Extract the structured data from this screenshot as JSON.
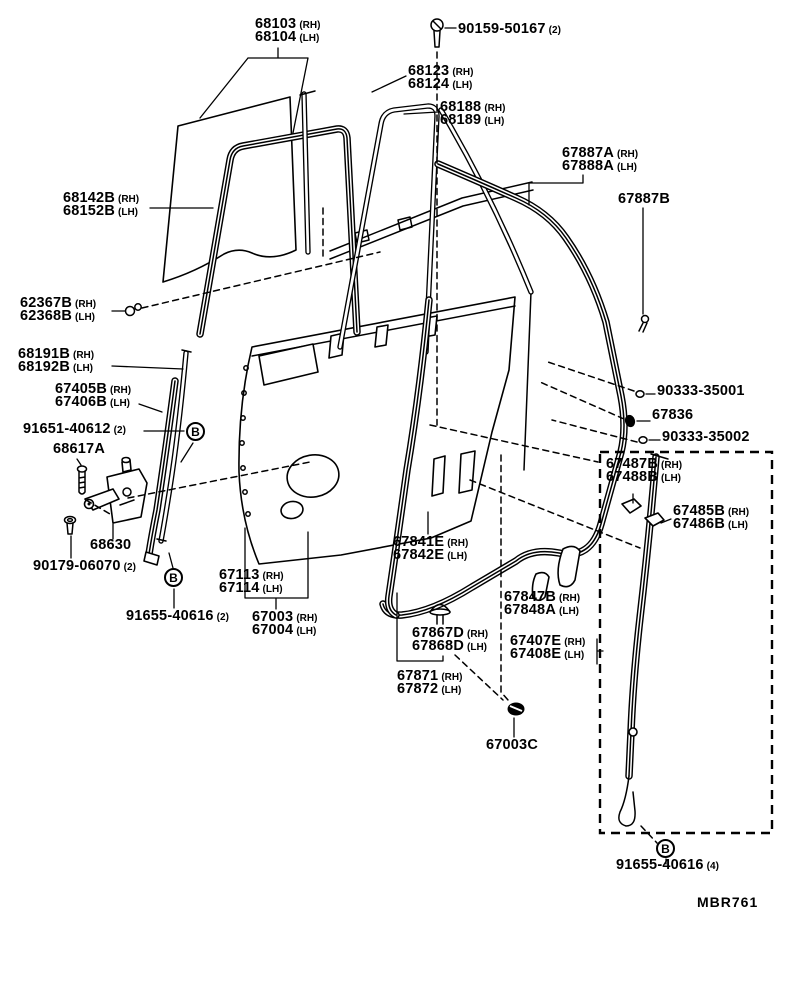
{
  "figure": {
    "code": "MBR761"
  },
  "labels": [
    {
      "id": "68103-68104",
      "x": 255,
      "y": 17,
      "rows": [
        {
          "num": "68103",
          "suffix": "(RH)"
        },
        {
          "num": "68104",
          "suffix": "(LH)"
        }
      ]
    },
    {
      "id": "90159-50167",
      "x": 458,
      "y": 22,
      "rows": [
        {
          "num": "90159-50167",
          "suffix": "(2)"
        }
      ]
    },
    {
      "id": "68123-68124",
      "x": 408,
      "y": 64,
      "rows": [
        {
          "num": "68123",
          "suffix": "(RH)"
        },
        {
          "num": "68124",
          "suffix": "(LH)"
        }
      ]
    },
    {
      "id": "68188-68189",
      "x": 440,
      "y": 100,
      "rows": [
        {
          "num": "68188",
          "suffix": "(RH)"
        },
        {
          "num": "68189",
          "suffix": "(LH)"
        }
      ]
    },
    {
      "id": "67887A-67888A",
      "x": 562,
      "y": 146,
      "rows": [
        {
          "num": "67887A",
          "suffix": "(RH)"
        },
        {
          "num": "67888A",
          "suffix": "(LH)"
        }
      ]
    },
    {
      "id": "67887B",
      "x": 618,
      "y": 192,
      "rows": [
        {
          "num": "67887B",
          "suffix": ""
        }
      ]
    },
    {
      "id": "68142B-68152B",
      "x": 63,
      "y": 191,
      "rows": [
        {
          "num": "68142B",
          "suffix": "(RH)"
        },
        {
          "num": "68152B",
          "suffix": "(LH)"
        }
      ]
    },
    {
      "id": "62367B-62368B",
      "x": 20,
      "y": 296,
      "rows": [
        {
          "num": "62367B",
          "suffix": "(RH)"
        },
        {
          "num": "62368B",
          "suffix": "(LH)"
        }
      ]
    },
    {
      "id": "68191B-68192B",
      "x": 18,
      "y": 347,
      "rows": [
        {
          "num": "68191B",
          "suffix": "(RH)"
        },
        {
          "num": "68192B",
          "suffix": "(LH)"
        }
      ]
    },
    {
      "id": "67405B-67406B",
      "x": 55,
      "y": 382,
      "rows": [
        {
          "num": "67405B",
          "suffix": "(RH)"
        },
        {
          "num": "67406B",
          "suffix": "(LH)"
        }
      ]
    },
    {
      "id": "91651-40612",
      "x": 23,
      "y": 422,
      "rows": [
        {
          "num": "91651-40612",
          "suffix": "(2)"
        }
      ]
    },
    {
      "id": "68617A",
      "x": 53,
      "y": 442,
      "rows": [
        {
          "num": "68617A",
          "suffix": ""
        }
      ]
    },
    {
      "id": "68630",
      "x": 90,
      "y": 538,
      "rows": [
        {
          "num": "68630",
          "suffix": ""
        }
      ]
    },
    {
      "id": "90179-06070",
      "x": 33,
      "y": 559,
      "rows": [
        {
          "num": "90179-06070",
          "suffix": "(2)"
        }
      ]
    },
    {
      "id": "91655-40616-2",
      "x": 126,
      "y": 609,
      "rows": [
        {
          "num": "91655-40616",
          "suffix": "(2)"
        }
      ]
    },
    {
      "id": "67113-67114",
      "x": 219,
      "y": 568,
      "rows": [
        {
          "num": "67113",
          "suffix": "(RH)"
        },
        {
          "num": "67114",
          "suffix": "(LH)"
        }
      ]
    },
    {
      "id": "67003-67004",
      "x": 252,
      "y": 610,
      "rows": [
        {
          "num": "67003",
          "suffix": "(RH)"
        },
        {
          "num": "67004",
          "suffix": "(LH)"
        }
      ]
    },
    {
      "id": "67841E-67842E",
      "x": 393,
      "y": 535,
      "rows": [
        {
          "num": "67841E",
          "suffix": "(RH)"
        },
        {
          "num": "67842E",
          "suffix": "(LH)"
        }
      ]
    },
    {
      "id": "67867D-67868D",
      "x": 412,
      "y": 626,
      "rows": [
        {
          "num": "67867D",
          "suffix": "(RH)"
        },
        {
          "num": "67868D",
          "suffix": "(LH)"
        }
      ]
    },
    {
      "id": "67871-67872",
      "x": 397,
      "y": 669,
      "rows": [
        {
          "num": "67871",
          "suffix": "(RH)"
        },
        {
          "num": "67872",
          "suffix": "(LH)"
        }
      ]
    },
    {
      "id": "67003C",
      "x": 486,
      "y": 738,
      "rows": [
        {
          "num": "67003C",
          "suffix": ""
        }
      ]
    },
    {
      "id": "67847B-67848A",
      "x": 504,
      "y": 590,
      "rows": [
        {
          "num": "67847B",
          "suffix": "(RH)"
        },
        {
          "num": "67848A",
          "suffix": "(LH)"
        }
      ]
    },
    {
      "id": "67407E-67408E",
      "x": 510,
      "y": 634,
      "rows": [
        {
          "num": "67407E",
          "suffix": "(RH)"
        },
        {
          "num": "67408E",
          "suffix": "(LH)"
        }
      ]
    },
    {
      "id": "90333-35001",
      "x": 657,
      "y": 384,
      "rows": [
        {
          "num": "90333-35001",
          "suffix": ""
        }
      ]
    },
    {
      "id": "67836",
      "x": 652,
      "y": 408,
      "rows": [
        {
          "num": "67836",
          "suffix": ""
        }
      ]
    },
    {
      "id": "90333-35002",
      "x": 662,
      "y": 430,
      "rows": [
        {
          "num": "90333-35002",
          "suffix": ""
        }
      ]
    },
    {
      "id": "67487B-67488B",
      "x": 606,
      "y": 457,
      "rows": [
        {
          "num": "67487B",
          "suffix": "(RH)"
        },
        {
          "num": "67488B",
          "suffix": "(LH)"
        }
      ]
    },
    {
      "id": "67485B-67486B",
      "x": 673,
      "y": 504,
      "rows": [
        {
          "num": "67485B",
          "suffix": "(RH)"
        },
        {
          "num": "67486B",
          "suffix": "(LH)"
        }
      ]
    },
    {
      "id": "91655-40616-4",
      "x": 616,
      "y": 858,
      "rows": [
        {
          "num": "91655-40616",
          "suffix": "(4)"
        }
      ]
    }
  ],
  "markers": [
    {
      "letter": "B",
      "x": 196,
      "y": 432
    },
    {
      "letter": "B",
      "x": 174,
      "y": 578
    },
    {
      "letter": "B",
      "x": 666,
      "y": 849
    }
  ]
}
